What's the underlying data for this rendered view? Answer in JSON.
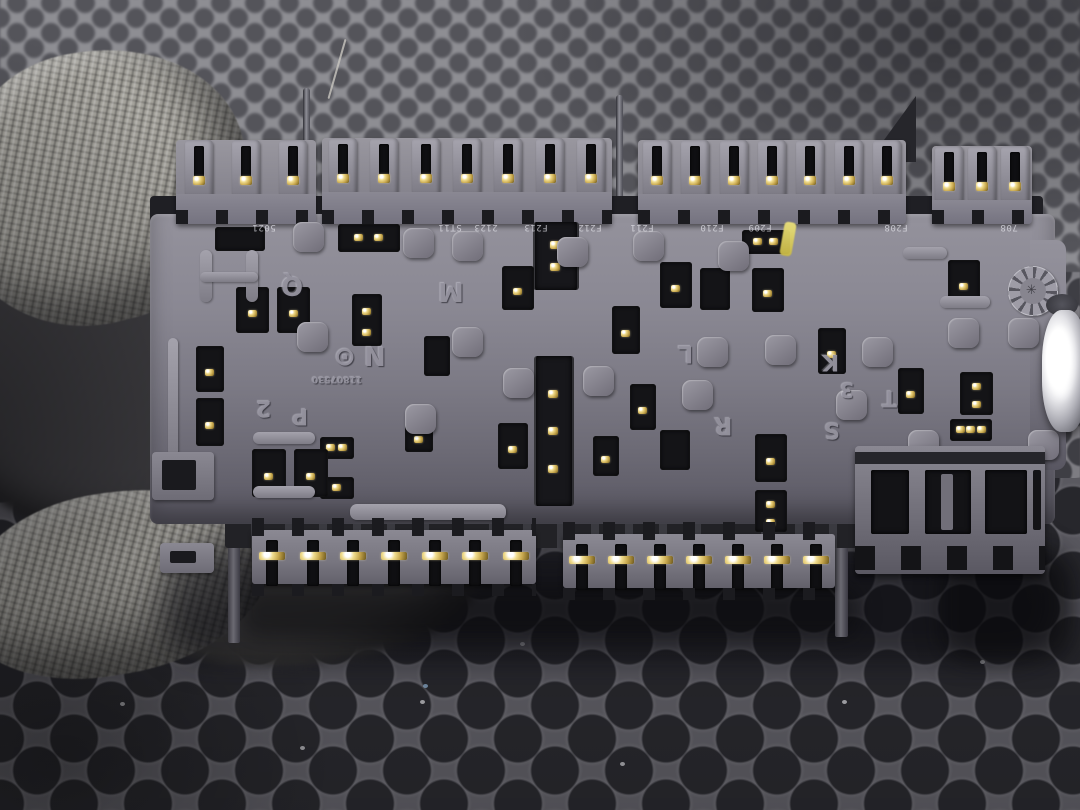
{
  "meta": {
    "description": "Photo: rear side of a black automotive fuse/relay junction box with connector pin rows, held by a gray knit glove over a dark rubber honeycomb mat",
    "width": 1080,
    "height": 810
  },
  "palette": {
    "mat_light": "#8e8e93",
    "mat_mid": "#7d7c82",
    "mat_dark": "#5a5960",
    "hole_light": "#55555b",
    "hole_mid": "#3f3f45",
    "hole_dark": "#28282d",
    "plastic_light": "#97959f",
    "plastic_mid": "#7c7a85",
    "plastic_dark": "#5a5862",
    "socket_black": "#141417",
    "gold_pin": "#e8d080",
    "glove_gray": "#a6a49d",
    "metal_white": "#ffffff",
    "yellow_mark": "#ddd45e"
  },
  "mat": {
    "bands": [
      {
        "y": -12,
        "h": 305,
        "size": 34,
        "r": 9,
        "base": "#8e8e93",
        "hole": "#54545a",
        "blur": 1.2
      },
      {
        "y": 272,
        "h": 225,
        "size": 46,
        "r": 13,
        "base": "#7d7c82",
        "hole": "#3e3e44",
        "blur": 0.6
      },
      {
        "y": 478,
        "h": 335,
        "size": 74,
        "r": 23,
        "base": "#5a5960",
        "hole": "#27272c",
        "blur": 0
      }
    ],
    "specks": [
      [
        420,
        700,
        "#cfcfd2"
      ],
      [
        620,
        762,
        "#c8c8cc"
      ],
      [
        842,
        700,
        "#d2d2d6"
      ],
      [
        300,
        746,
        "#c4c4c8"
      ],
      [
        980,
        660,
        "#d6d6da"
      ],
      [
        520,
        642,
        "#cacace"
      ],
      [
        1036,
        560,
        "#e2e2e6"
      ],
      [
        120,
        702,
        "#bfbfc3"
      ],
      [
        423,
        684,
        "#8fb0d0"
      ]
    ]
  },
  "glove": {
    "parts": [
      {
        "name": "glove-palm-shadow",
        "x": -70,
        "y": 195,
        "w": 390,
        "h": 345,
        "rot": 10,
        "tone": "dark",
        "blur": 4
      },
      {
        "name": "glove-thumb",
        "x": -50,
        "y": 50,
        "w": 300,
        "h": 272,
        "rot": -14,
        "tone": "light",
        "blur": 0.4
      },
      {
        "name": "glove-fingertip-shade",
        "x": 150,
        "y": 530,
        "w": 330,
        "h": 132,
        "rot": -6,
        "tone": "mid",
        "blur": 5
      },
      {
        "name": "glove-finger",
        "x": -40,
        "y": 492,
        "w": 312,
        "h": 182,
        "rot": -10,
        "tone": "light",
        "blur": 0.4
      }
    ],
    "fiber": {
      "x": 336,
      "y": 38,
      "h": 62,
      "rot": 16
    }
  },
  "shadows": [
    {
      "x": 160,
      "y": 545,
      "w": 900,
      "h": 115,
      "c": "rgba(8,8,12,0.55)",
      "blur": 16,
      "r": 50
    },
    {
      "x": 940,
      "y": 550,
      "w": 135,
      "h": 112,
      "c": "rgba(5,5,8,0.5)",
      "blur": 12,
      "r": 30
    },
    {
      "x": 240,
      "y": 585,
      "w": 620,
      "h": 52,
      "c": "rgba(10,10,12,0.5)",
      "blur": 10,
      "r": 20
    }
  ],
  "fusebox": {
    "body": {
      "x": 150,
      "y": 214,
      "w": 905,
      "h": 310
    },
    "endcap": {
      "x": 1030,
      "y": 240,
      "w": 36,
      "h": 230
    },
    "top_base": {
      "x": 150,
      "y": 196,
      "w": 893,
      "h": 42
    },
    "bottom_base": {
      "x": 225,
      "y": 512,
      "w": 632,
      "h": 36
    },
    "top_modules": [
      {
        "x": 176,
        "y": 140,
        "w": 140,
        "h": 84,
        "tabs": 3
      },
      {
        "x": 322,
        "y": 138,
        "w": 290,
        "h": 86,
        "tabs": 7
      },
      {
        "x": 638,
        "y": 140,
        "w": 268,
        "h": 84,
        "tabs": 7
      },
      {
        "x": 932,
        "y": 146,
        "w": 100,
        "h": 78,
        "tabs": 3
      }
    ],
    "stand_pins": [
      {
        "x": 303,
        "y": 88,
        "h": 130
      },
      {
        "x": 616,
        "y": 95,
        "h": 123
      }
    ],
    "fin": {
      "x": 868,
      "y": 96,
      "w": 48,
      "h": 66
    },
    "top_labels": [
      {
        "x": 252,
        "t": "5021"
      },
      {
        "x": 438,
        "t": "ST11"
      },
      {
        "x": 474,
        "t": "2123"
      },
      {
        "x": 524,
        "t": "F213"
      },
      {
        "x": 578,
        "t": "F212"
      },
      {
        "x": 630,
        "t": "F211"
      },
      {
        "x": 700,
        "t": "F210"
      },
      {
        "x": 748,
        "t": "F209"
      },
      {
        "x": 884,
        "t": "F208"
      },
      {
        "x": 1000,
        "t": "708"
      }
    ],
    "yellow_mark": {
      "x": 782,
      "y": 222,
      "w": 12,
      "h": 34
    },
    "letters": [
      {
        "t": "Q",
        "x": 281,
        "y": 272,
        "s": 26
      },
      {
        "t": "M",
        "x": 438,
        "y": 278,
        "s": 26
      },
      {
        "t": "⊙",
        "x": 334,
        "y": 344,
        "s": 26
      },
      {
        "t": "N",
        "x": 364,
        "y": 342,
        "s": 26
      },
      {
        "t": "11807530",
        "x": 312,
        "y": 374,
        "s": 9
      },
      {
        "t": "2",
        "x": 256,
        "y": 396,
        "s": 22
      },
      {
        "t": "P",
        "x": 292,
        "y": 404,
        "s": 22
      },
      {
        "t": "L",
        "x": 678,
        "y": 342,
        "s": 24
      },
      {
        "t": "R",
        "x": 714,
        "y": 414,
        "s": 24
      },
      {
        "t": "K",
        "x": 822,
        "y": 350,
        "s": 22
      },
      {
        "t": "3",
        "x": 840,
        "y": 380,
        "s": 20
      },
      {
        "t": "T",
        "x": 882,
        "y": 386,
        "s": 22
      },
      {
        "t": "S",
        "x": 824,
        "y": 418,
        "s": 22
      }
    ],
    "stamp": {
      "x": 1008,
      "y": 266,
      "d": 48,
      "digits": "1 2 3 4 5 6 7 8 9 10 11 12"
    },
    "channels": [
      {
        "x": 533,
        "y": 222,
        "w": 42,
        "h": 68,
        "pins": 2
      },
      {
        "x": 534,
        "y": 356,
        "w": 36,
        "h": 150,
        "pins": 3
      }
    ],
    "sockets": [
      [
        215,
        227,
        50,
        24,
        "h",
        0
      ],
      [
        338,
        224,
        62,
        28,
        "h",
        2
      ],
      [
        742,
        230,
        48,
        24,
        "h",
        2
      ],
      [
        660,
        262,
        32,
        46,
        "v",
        1
      ],
      [
        700,
        268,
        30,
        42,
        "v",
        0
      ],
      [
        752,
        268,
        32,
        44,
        "v",
        1
      ],
      [
        948,
        260,
        32,
        46,
        "v",
        1
      ],
      [
        236,
        287,
        33,
        46,
        "v",
        1
      ],
      [
        277,
        287,
        33,
        46,
        "v",
        1
      ],
      [
        502,
        266,
        32,
        44,
        "v",
        1
      ],
      [
        352,
        294,
        30,
        52,
        "v",
        2
      ],
      [
        424,
        336,
        26,
        40,
        "v",
        0
      ],
      [
        612,
        306,
        28,
        48,
        "v",
        1
      ],
      [
        818,
        328,
        28,
        46,
        "v",
        1
      ],
      [
        898,
        368,
        26,
        46,
        "v",
        1
      ],
      [
        960,
        372,
        33,
        43,
        "v",
        2
      ],
      [
        196,
        346,
        28,
        46,
        "v",
        1
      ],
      [
        196,
        398,
        28,
        48,
        "v",
        1
      ],
      [
        630,
        384,
        26,
        46,
        "v",
        1
      ],
      [
        593,
        436,
        26,
        40,
        "v",
        1
      ],
      [
        755,
        434,
        32,
        48,
        "v",
        1
      ],
      [
        755,
        490,
        32,
        42,
        "v",
        2
      ],
      [
        320,
        437,
        34,
        22,
        "h",
        2
      ],
      [
        320,
        477,
        34,
        22,
        "h",
        1
      ],
      [
        252,
        449,
        34,
        48,
        "v",
        1
      ],
      [
        294,
        449,
        34,
        48,
        "v",
        1
      ],
      [
        405,
        420,
        28,
        32,
        "v",
        1
      ],
      [
        498,
        423,
        30,
        46,
        "v",
        1
      ],
      [
        660,
        430,
        30,
        40,
        "v",
        0
      ],
      [
        950,
        419,
        42,
        22,
        "h",
        3
      ]
    ],
    "bumps": [
      [
        293,
        222
      ],
      [
        403,
        228
      ],
      [
        452,
        231
      ],
      [
        557,
        237
      ],
      [
        633,
        231
      ],
      [
        718,
        241
      ],
      [
        297,
        322
      ],
      [
        452,
        327
      ],
      [
        697,
        337
      ],
      [
        765,
        335
      ],
      [
        862,
        337
      ],
      [
        948,
        318
      ],
      [
        1008,
        318
      ],
      [
        503,
        368
      ],
      [
        583,
        366
      ],
      [
        682,
        380
      ],
      [
        405,
        404
      ],
      [
        836,
        390
      ],
      [
        908,
        430
      ],
      [
        1028,
        430
      ]
    ],
    "bars": [
      [
        350,
        504,
        156,
        16
      ],
      [
        253,
        432,
        62,
        12
      ],
      [
        253,
        486,
        62,
        12
      ],
      [
        903,
        247,
        44,
        12
      ],
      [
        940,
        296,
        50,
        12
      ],
      [
        200,
        250,
        12,
        52
      ],
      [
        246,
        250,
        12,
        52
      ],
      [
        200,
        272,
        58,
        10
      ],
      [
        168,
        338,
        10,
        118
      ]
    ],
    "legs": [
      [
        228,
        505,
        12,
        138
      ],
      [
        835,
        515,
        13,
        122
      ]
    ],
    "left_tabs": [
      [
        152,
        452,
        62,
        48
      ],
      [
        160,
        543,
        54,
        30
      ]
    ],
    "bottom_modules": [
      {
        "x": 252,
        "y": 518,
        "w": 284,
        "h": 78,
        "pins": 7
      },
      {
        "x": 563,
        "y": 522,
        "w": 272,
        "h": 78,
        "pins": 7
      }
    ],
    "right_connector": {
      "x": 855,
      "y": 446,
      "w": 190,
      "h": 128
    },
    "stud": {
      "x": 1042,
      "y": 288
    }
  }
}
